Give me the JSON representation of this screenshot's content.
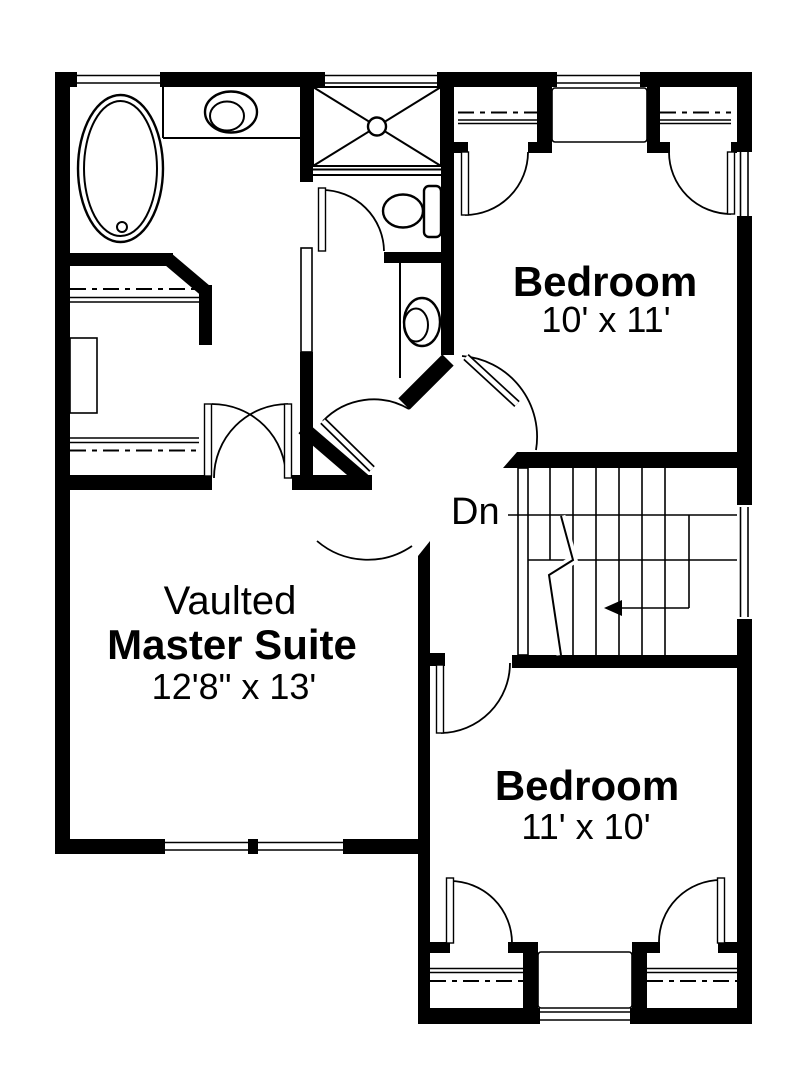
{
  "labels": {
    "bedroom_top": {
      "name": "Bedroom",
      "size": "10' x 11'"
    },
    "master_suite": {
      "prefix": "Vaulted",
      "name": "Master Suite",
      "size": "12'8\" x 13'"
    },
    "bedroom_bottom": {
      "name": "Bedroom",
      "size": "11' x 10'"
    },
    "stairs": {
      "direction": "Dn"
    }
  },
  "colors": {
    "wall": "#000000",
    "line": "#000000",
    "background": "#ffffff"
  },
  "fixtures": [
    "bathtub-icon",
    "vanity-sink-icon",
    "shower-stall-icon",
    "toilet-icon",
    "basin-sink-icon",
    "closet-rod-lines",
    "closet-shelf-unit",
    "staircase-down",
    "window-symbols",
    "door-swing-symbols"
  ]
}
